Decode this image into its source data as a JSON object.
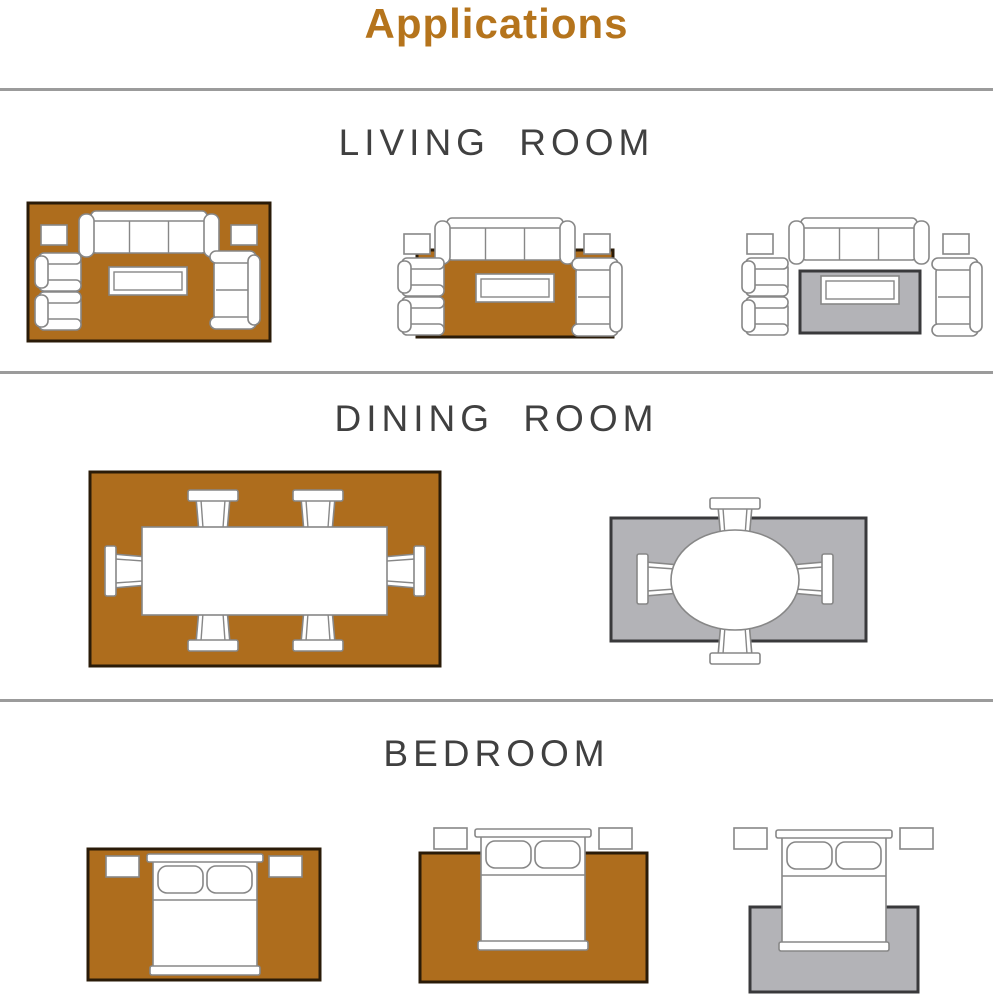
{
  "title": "Applications",
  "colors": {
    "page_background": "#ffffff",
    "title_text": "#b5741c",
    "heading_text": "#404040",
    "divider": "#9b9b9b",
    "rug_orange": "#ae6d1d",
    "rug_orange_border": "#2a1b08",
    "rug_gray": "#b3b3b7",
    "rug_gray_border": "#39393b",
    "furniture_stroke": "#878787",
    "furniture_fill": "#ffffff"
  },
  "sections": [
    {
      "heading": "LIVING ROOM",
      "diagrams": [
        {
          "name": "rug-under-all-living-furniture",
          "rug": "large-orange"
        },
        {
          "name": "rug-under-front-legs",
          "rug": "medium-orange"
        },
        {
          "name": "rug-under-coffee-table-only",
          "rug": "small-gray"
        }
      ]
    },
    {
      "heading": "DINING ROOM",
      "diagrams": [
        {
          "name": "rug-under-table-and-six-chairs",
          "rug": "large-orange"
        },
        {
          "name": "rug-under-round-table-chairs-overhang",
          "rug": "small-gray"
        }
      ]
    },
    {
      "heading": "BEDROOM",
      "diagrams": [
        {
          "name": "rug-under-bed-and-nightstands",
          "rug": "large-orange"
        },
        {
          "name": "rug-under-lower-two-thirds-of-bed",
          "rug": "medium-orange"
        },
        {
          "name": "rug-under-foot-of-bed",
          "rug": "small-gray"
        }
      ]
    }
  ]
}
